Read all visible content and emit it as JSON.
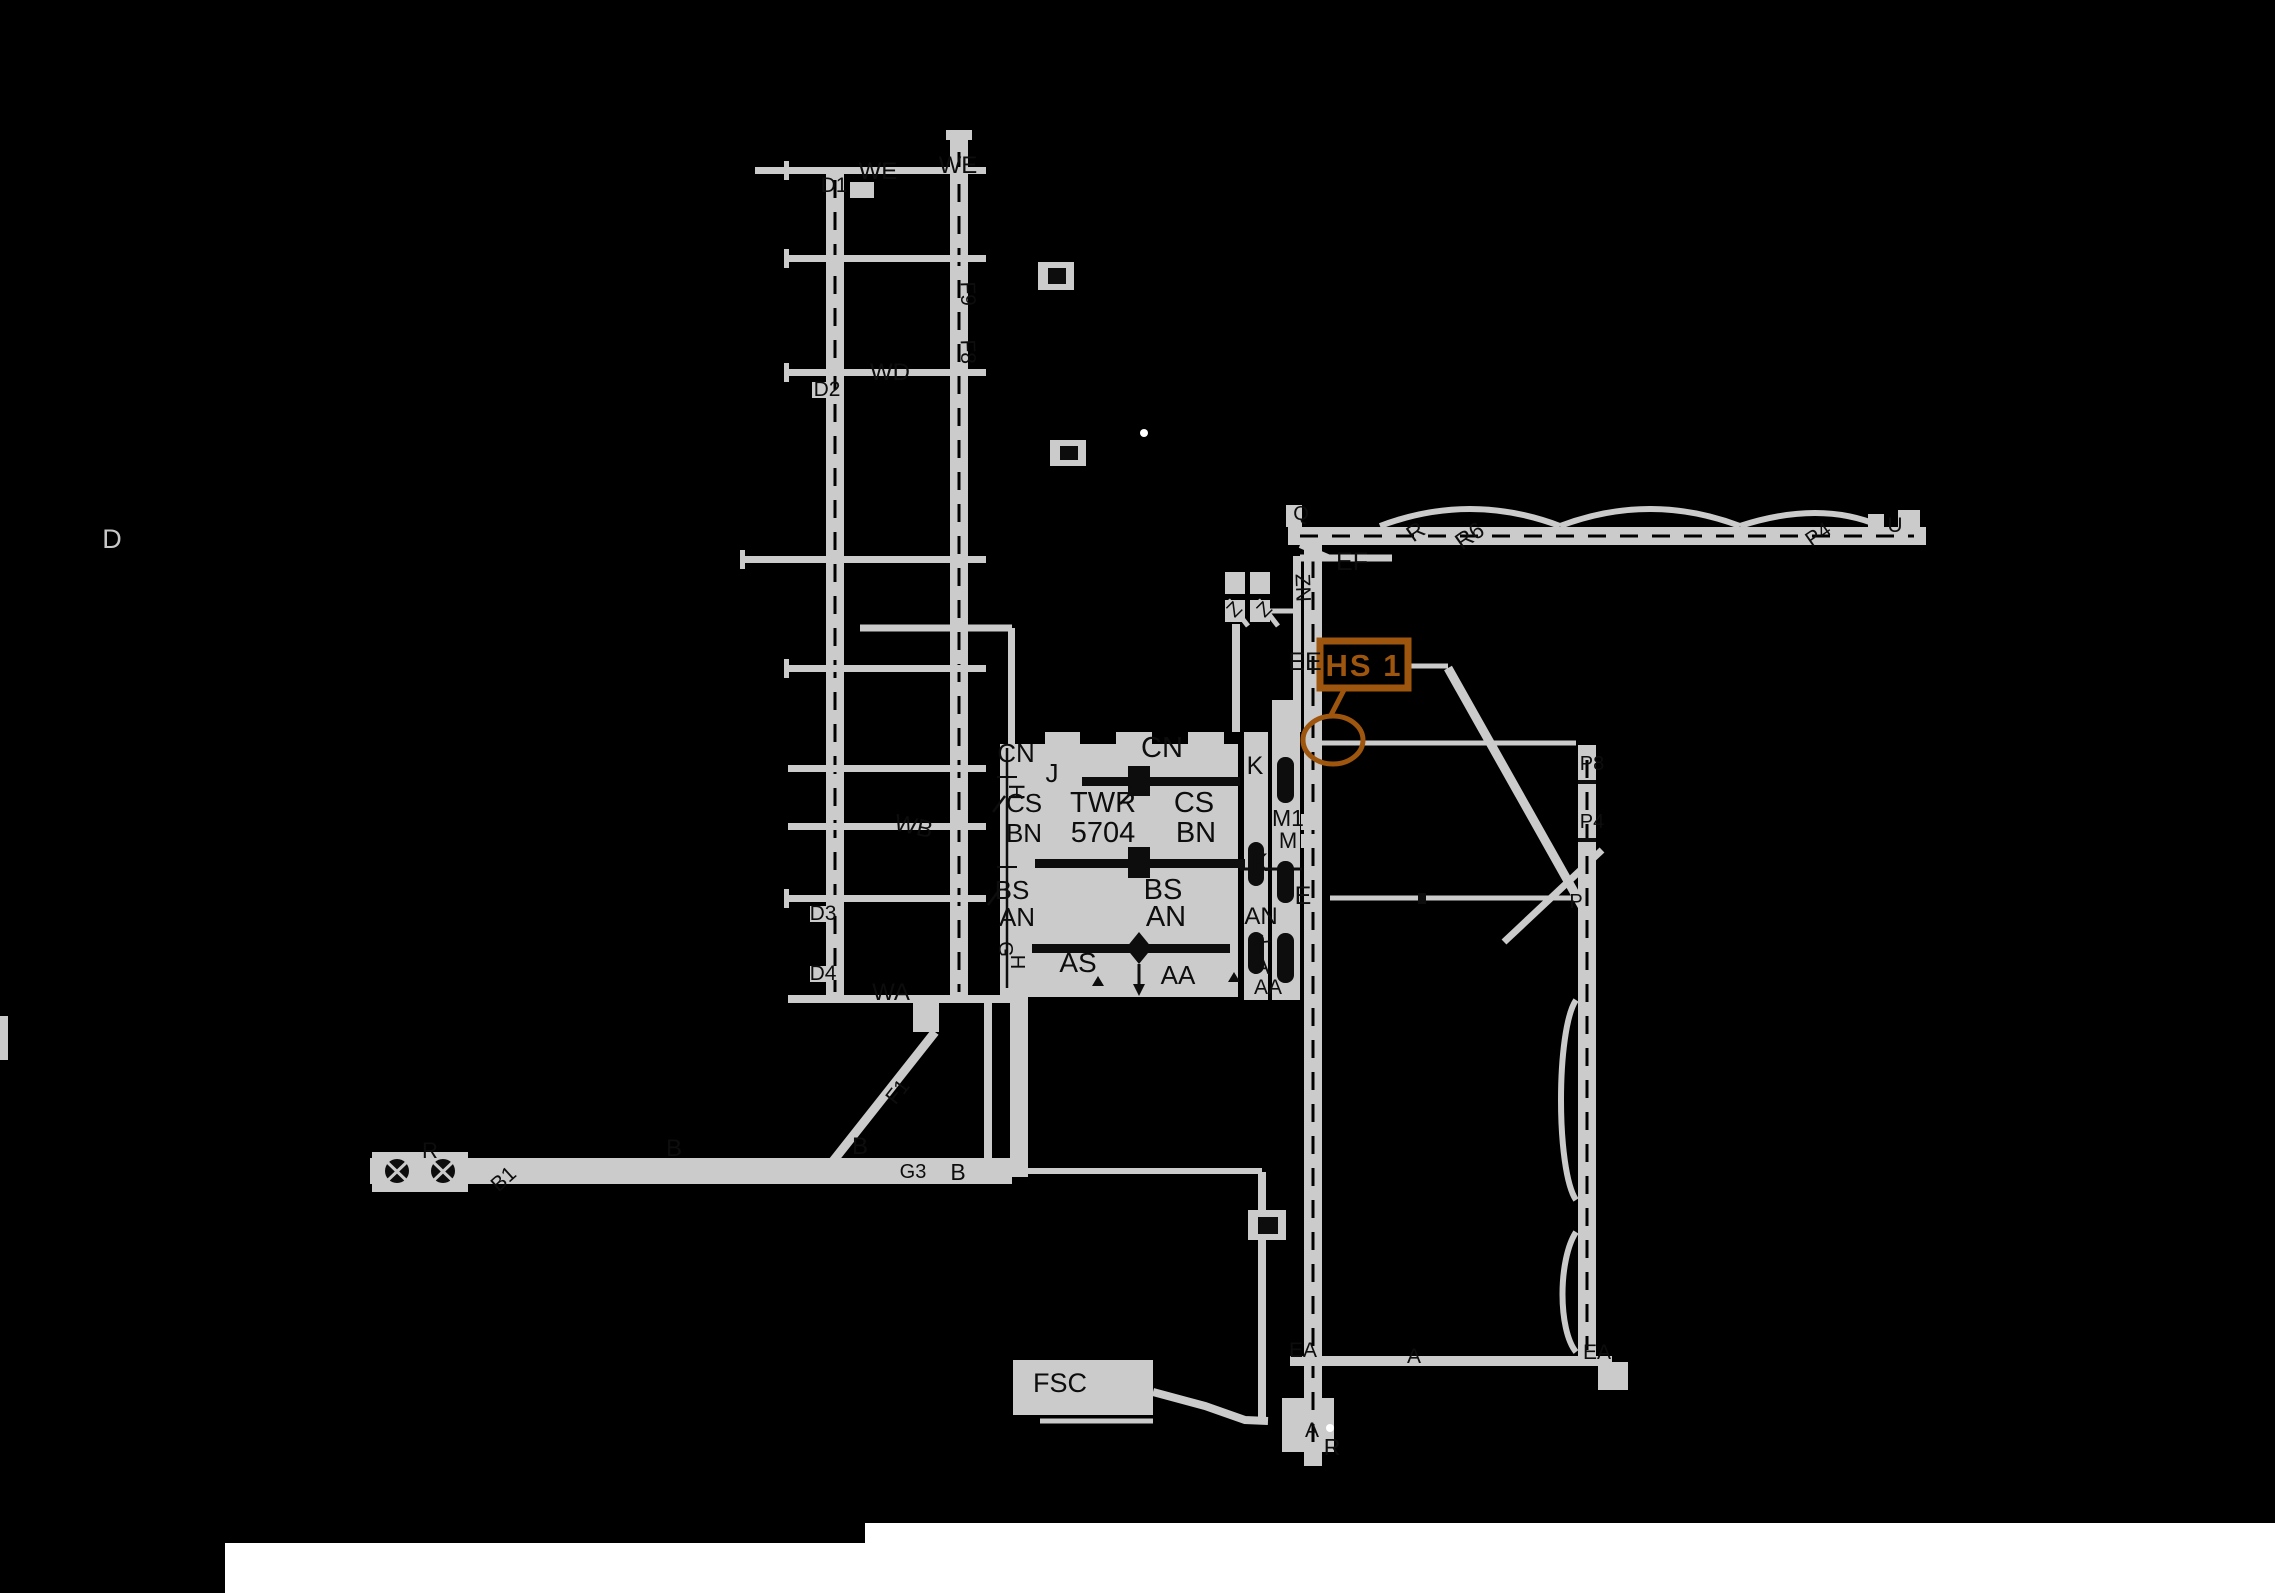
{
  "canvas": {
    "palette": {
      "background": "#000000",
      "pavement_gray": "#CBCBCB",
      "ink_dark": "#0D0D0D",
      "label_gray": "#C8C8C8",
      "accent_orange": "#9E560F",
      "page_white": "#FFFFFF"
    }
  },
  "hotspot": {
    "label": "HS 1"
  },
  "tower": {
    "label": "TWR",
    "elevation": "5704"
  },
  "labels": [
    {
      "t": "WE",
      "x": 878,
      "y": 179,
      "s": 24,
      "c": "dark",
      "n": "taxiway-we-label"
    },
    {
      "t": "WE",
      "x": 958,
      "y": 173,
      "s": 24,
      "c": "dark",
      "n": "taxiway-we-label"
    },
    {
      "t": "D1",
      "x": 834,
      "y": 192,
      "s": 21,
      "c": "dark",
      "n": "pad-d1-label"
    },
    {
      "t": "D2",
      "x": 827,
      "y": 396,
      "s": 21,
      "c": "dark",
      "n": "pad-d2-label"
    },
    {
      "t": "WD",
      "x": 890,
      "y": 380,
      "s": 24,
      "c": "dark",
      "n": "taxiway-wd-label"
    },
    {
      "t": "F9",
      "x": 961,
      "y": 294,
      "s": 21,
      "c": "dark",
      "r": 88,
      "n": "taxiway-f9-label"
    },
    {
      "t": "F8",
      "x": 961,
      "y": 352,
      "s": 21,
      "c": "dark",
      "r": 88,
      "n": "taxiway-f8-label"
    },
    {
      "t": "WB",
      "x": 912,
      "y": 834,
      "s": 24,
      "c": "dark",
      "r": 12,
      "n": "taxiway-wb-label"
    },
    {
      "t": "D3",
      "x": 823,
      "y": 920,
      "s": 21,
      "c": "dark",
      "n": "pad-d3-label"
    },
    {
      "t": "D4",
      "x": 823,
      "y": 980,
      "s": 21,
      "c": "dark",
      "n": "pad-d4-label"
    },
    {
      "t": "WA",
      "x": 891,
      "y": 1000,
      "s": 24,
      "c": "dark",
      "n": "taxiway-wa-label"
    },
    {
      "t": "D",
      "x": 112,
      "y": 548,
      "s": 27,
      "c": "gray",
      "n": "taxiway-d-label"
    },
    {
      "t": "R",
      "x": 430,
      "y": 1158,
      "s": 22,
      "c": "dark",
      "n": "taxiway-r-label"
    },
    {
      "t": "B1",
      "x": 508,
      "y": 1184,
      "s": 21,
      "c": "dark",
      "r": -42,
      "n": "taxiway-b1-label"
    },
    {
      "t": "B",
      "x": 674,
      "y": 1156,
      "s": 24,
      "c": "dark",
      "n": "taxiway-b-label"
    },
    {
      "t": "B",
      "x": 860,
      "y": 1154,
      "s": 24,
      "c": "dark",
      "n": "taxiway-b-label"
    },
    {
      "t": "F1",
      "x": 903,
      "y": 1096,
      "s": 21,
      "c": "dark",
      "r": -52,
      "n": "taxiway-f1-label"
    },
    {
      "t": "G3",
      "x": 913,
      "y": 1178,
      "s": 20,
      "c": "dark",
      "n": "taxiway-g3-label"
    },
    {
      "t": "B",
      "x": 958,
      "y": 1180,
      "s": 23,
      "c": "dark",
      "n": "taxiway-b-label"
    },
    {
      "t": "FSC",
      "x": 1060,
      "y": 1392,
      "s": 27,
      "c": "dark",
      "n": "fsc-building-label"
    },
    {
      "t": "A",
      "x": 1312,
      "y": 1437,
      "s": 21,
      "c": "dark",
      "n": "taxiway-a-label"
    },
    {
      "t": "R",
      "x": 1332,
      "y": 1455,
      "s": 23,
      "c": "dark",
      "n": "taxiway-r-label"
    },
    {
      "t": "EA",
      "x": 1303,
      "y": 1357,
      "s": 21,
      "c": "dark",
      "n": "taxiway-ea-label"
    },
    {
      "t": "A",
      "x": 1414,
      "y": 1363,
      "s": 21,
      "c": "dark",
      "n": "taxiway-a-label"
    },
    {
      "t": "EA",
      "x": 1597,
      "y": 1359,
      "s": 21,
      "c": "dark",
      "n": "taxiway-ea-label"
    },
    {
      "t": "CN",
      "x": 1016,
      "y": 762,
      "s": 26,
      "c": "dark",
      "n": "taxiway-cn-label"
    },
    {
      "t": "H",
      "x": 1009,
      "y": 792,
      "s": 22,
      "c": "dark",
      "r": 90,
      "n": "taxiway-h-label"
    },
    {
      "t": "J",
      "x": 1052,
      "y": 782,
      "s": 26,
      "c": "dark",
      "n": "taxiway-j-label"
    },
    {
      "t": "CS",
      "x": 1024,
      "y": 812,
      "s": 26,
      "c": "dark",
      "n": "taxiway-cs-label"
    },
    {
      "t": "BN",
      "x": 1024,
      "y": 842,
      "s": 26,
      "c": "dark",
      "n": "taxiway-bn-label"
    },
    {
      "t": "BS",
      "x": 1012,
      "y": 899,
      "s": 26,
      "c": "dark",
      "n": "taxiway-bs-label"
    },
    {
      "t": "AN",
      "x": 1017,
      "y": 926,
      "s": 26,
      "c": "dark",
      "n": "taxiway-an-label"
    },
    {
      "t": "G",
      "x": 999,
      "y": 949,
      "s": 20,
      "c": "dark",
      "r": 90,
      "n": "taxiway-g-label"
    },
    {
      "t": "H",
      "x": 1011,
      "y": 962,
      "s": 20,
      "c": "dark",
      "r": 90,
      "n": "taxiway-h-label"
    },
    {
      "t": "AS",
      "x": 1078,
      "y": 972,
      "s": 28,
      "c": "dark",
      "n": "taxiway-as-label"
    },
    {
      "t": "AA",
      "x": 1178,
      "y": 984,
      "s": 26,
      "c": "dark",
      "n": "taxiway-aa-label"
    },
    {
      "t": "TWR",
      "x": 1103,
      "y": 812,
      "s": 29,
      "c": "dark",
      "n": "tower-label"
    },
    {
      "t": "5704",
      "x": 1103,
      "y": 842,
      "s": 29,
      "c": "dark",
      "n": "tower-elevation-label"
    },
    {
      "t": "CN",
      "x": 1162,
      "y": 757,
      "s": 29,
      "c": "dark",
      "n": "taxiway-cn-label"
    },
    {
      "t": "CS",
      "x": 1194,
      "y": 812,
      "s": 29,
      "c": "dark",
      "n": "taxiway-cs-label"
    },
    {
      "t": "BN",
      "x": 1196,
      "y": 842,
      "s": 29,
      "c": "dark",
      "n": "taxiway-bn-label"
    },
    {
      "t": "BS",
      "x": 1163,
      "y": 899,
      "s": 29,
      "c": "dark",
      "n": "taxiway-bs-label"
    },
    {
      "t": "AN",
      "x": 1166,
      "y": 926,
      "s": 29,
      "c": "dark",
      "n": "taxiway-an-label"
    },
    {
      "t": "K",
      "x": 1255,
      "y": 774,
      "s": 25,
      "c": "dark",
      "n": "taxiway-k-label"
    },
    {
      "t": "M1",
      "x": 1288,
      "y": 826,
      "s": 23,
      "c": "dark",
      "n": "taxiway-m1-label"
    },
    {
      "t": "M",
      "x": 1288,
      "y": 848,
      "s": 22,
      "c": "dark",
      "n": "taxiway-m-label"
    },
    {
      "t": "K",
      "x": 1260,
      "y": 871,
      "s": 25,
      "c": "dark",
      "n": "taxiway-k-label"
    },
    {
      "t": "E",
      "x": 1303,
      "y": 904,
      "s": 25,
      "c": "dark",
      "n": "taxiway-e-label"
    },
    {
      "t": "AN",
      "x": 1261,
      "y": 924,
      "s": 24,
      "c": "dark",
      "n": "taxiway-an-label"
    },
    {
      "t": "K",
      "x": 1256,
      "y": 950,
      "s": 23,
      "c": "dark",
      "r": 40,
      "n": "taxiway-k-label"
    },
    {
      "t": "A",
      "x": 1262,
      "y": 974,
      "s": 23,
      "c": "dark",
      "n": "taxiway-a-label"
    },
    {
      "t": "AA",
      "x": 1268,
      "y": 994,
      "s": 21,
      "c": "dark",
      "n": "taxiway-aa-label"
    },
    {
      "t": "ZN",
      "x": 1296,
      "y": 588,
      "s": 21,
      "c": "dark",
      "r": 88,
      "n": "taxiway-zn-label"
    },
    {
      "t": "Z",
      "x": 1239,
      "y": 614,
      "s": 20,
      "c": "dark",
      "r": -45,
      "n": "taxiway-z-label"
    },
    {
      "t": "Z",
      "x": 1269,
      "y": 614,
      "s": 20,
      "c": "dark",
      "r": -45,
      "n": "taxiway-z-label"
    },
    {
      "t": "EF",
      "x": 1352,
      "y": 570,
      "s": 25,
      "c": "dark",
      "n": "taxiway-ef-label"
    },
    {
      "t": "EE",
      "x": 1305,
      "y": 670,
      "s": 25,
      "c": "dark",
      "n": "taxiway-ee-label"
    },
    {
      "t": "Q",
      "x": 1301,
      "y": 520,
      "s": 20,
      "c": "dark",
      "n": "taxiway-q-label"
    },
    {
      "t": "R",
      "x": 1420,
      "y": 538,
      "s": 23,
      "c": "dark",
      "r": -35,
      "n": "taxiway-r-label"
    },
    {
      "t": "R6",
      "x": 1474,
      "y": 542,
      "s": 23,
      "c": "dark",
      "r": -35,
      "n": "taxiway-r6-label"
    },
    {
      "t": "P4",
      "x": 1822,
      "y": 540,
      "s": 21,
      "c": "dark",
      "r": -35,
      "n": "taxiway-p4-label"
    },
    {
      "t": "U",
      "x": 1895,
      "y": 532,
      "s": 21,
      "c": "dark",
      "n": "taxiway-u-label"
    },
    {
      "t": "P8",
      "x": 1592,
      "y": 770,
      "s": 20,
      "c": "dark",
      "n": "hold-p8-label"
    },
    {
      "t": "P4",
      "x": 1592,
      "y": 828,
      "s": 20,
      "c": "dark",
      "n": "hold-p4-label"
    },
    {
      "t": "P",
      "x": 1576,
      "y": 908,
      "s": 20,
      "c": "dark",
      "n": "taxiway-p-label"
    }
  ]
}
